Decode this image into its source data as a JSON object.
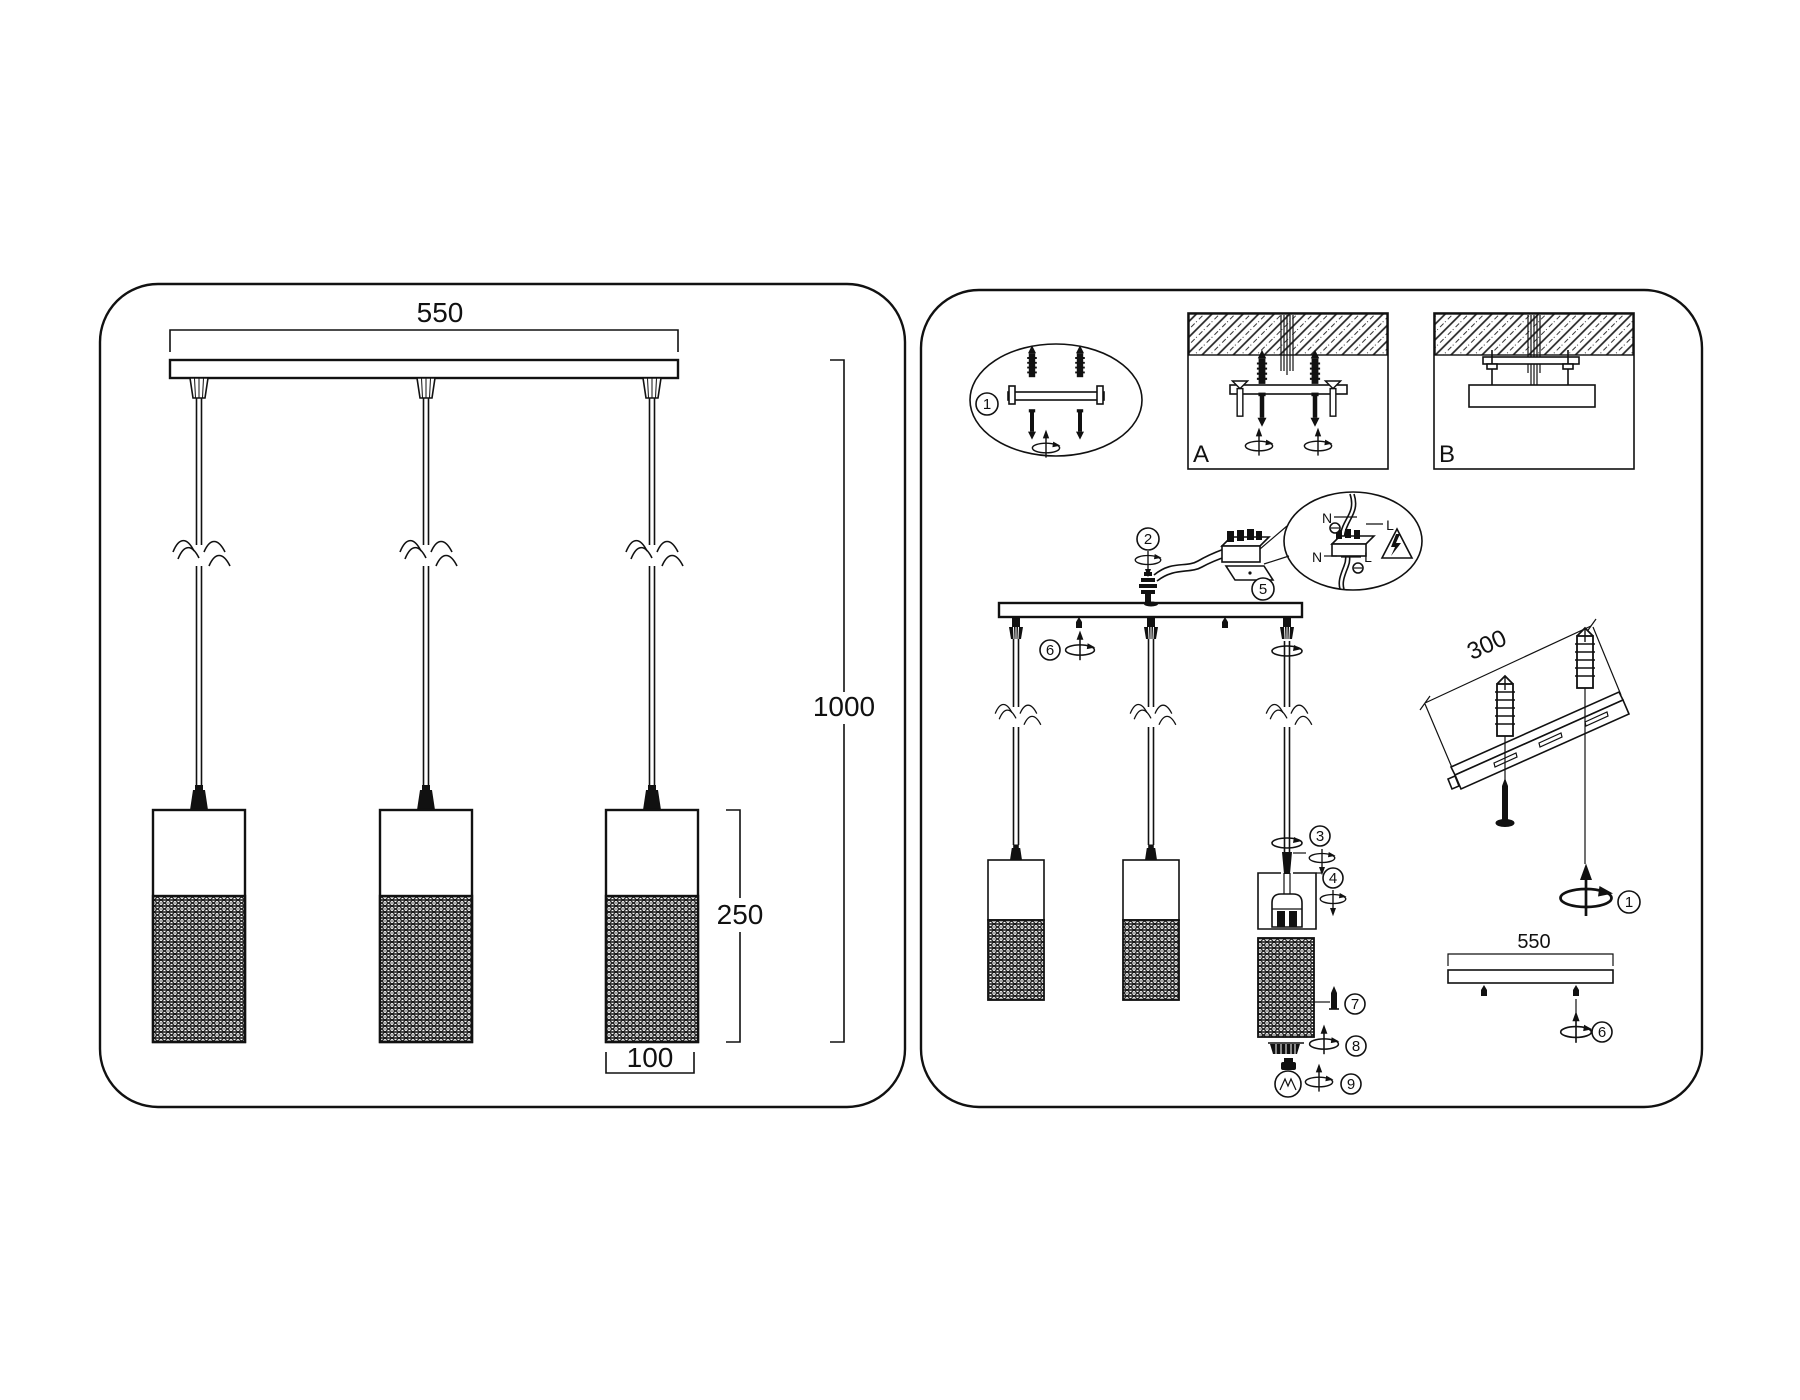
{
  "left": {
    "w": "550",
    "h": "1000",
    "shade_h": "250",
    "shade_d": "100"
  },
  "right": {
    "a": "A",
    "b": "B",
    "s1": "1",
    "s2": "2",
    "s3": "3",
    "s4": "4",
    "s5": "5",
    "s6": "6",
    "s7": "7",
    "s8": "8",
    "s9": "9",
    "rail": "300",
    "bar": "550",
    "n1": "N",
    "l1": "L",
    "n2": "N",
    "l2": "L"
  },
  "colors": {
    "line": "#111111",
    "background": "#ffffff"
  }
}
